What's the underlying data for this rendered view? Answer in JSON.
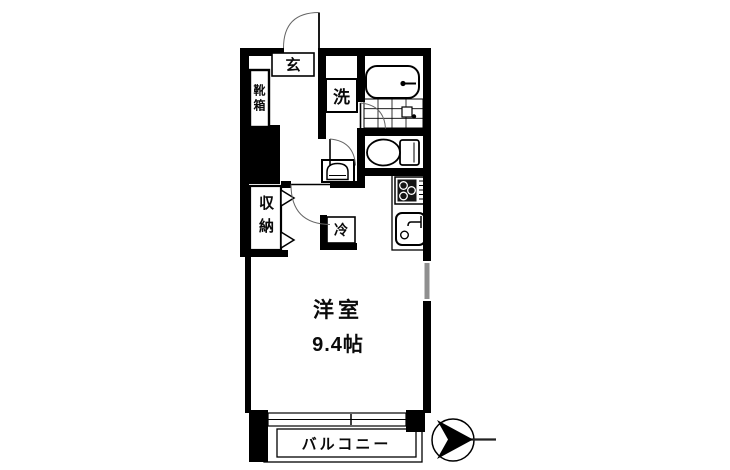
{
  "floorplan": {
    "unit_labels": {
      "entrance": "玄",
      "shoe_cabinet": "靴箱",
      "washing_machine": "洗",
      "closet": "収納",
      "refrigerator": "冷",
      "balcony": "バルコニー"
    },
    "main_room": {
      "name": "洋室",
      "size": "9.4帖"
    },
    "colors": {
      "wall": "#000000",
      "background": "#ffffff",
      "window": "#8f8f8f",
      "door_arc": "#666666",
      "compass": "#000000"
    }
  }
}
